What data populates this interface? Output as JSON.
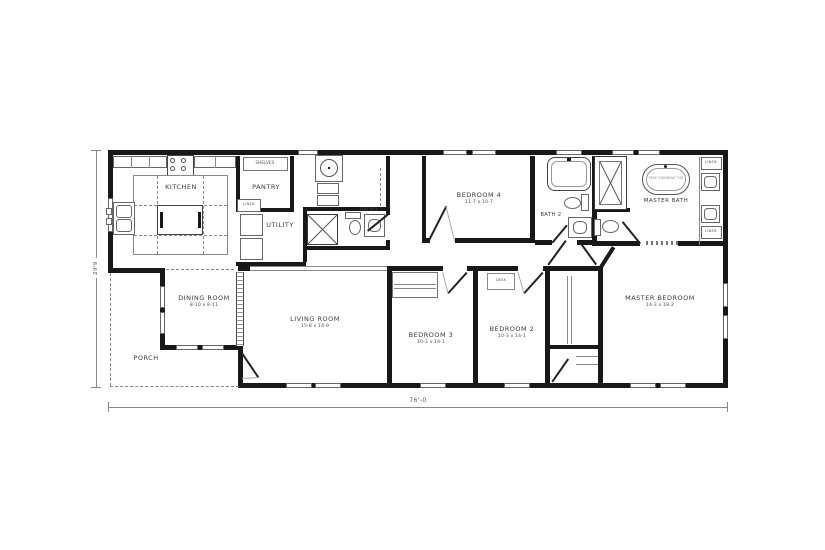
{
  "rooms": {
    "kitchen": {
      "label": "KITCHEN"
    },
    "pantry": {
      "label": "PANTRY"
    },
    "utility": {
      "label": "UTILITY"
    },
    "bath3": {
      "label": "BATH 3"
    },
    "bedroom4": {
      "label": "BEDROOM 4",
      "dims": "11-7 x 10-7"
    },
    "bath2": {
      "label": "BATH 2"
    },
    "master_bath": {
      "label": "MASTER BATH"
    },
    "dining_room": {
      "label": "DINING ROOM",
      "dims": "8-10 x 8-11"
    },
    "living_room": {
      "label": "LIVING ROOM",
      "dims": "15-8 x 14-9"
    },
    "bedroom3": {
      "label": "BEDROOM 3",
      "dims": "10-3 x 14-1"
    },
    "bedroom2": {
      "label": "BEDROOM 2",
      "dims": "10-3 x 14-1"
    },
    "master_bedroom": {
      "label": "MASTER BEDROOM",
      "dims": "14-3 x 18-2"
    },
    "porch": {
      "label": "PORCH"
    }
  },
  "callouts": {
    "shelves": "SHELVES",
    "pantry_linen": "LINEN",
    "linen_upper": "LINEN",
    "linen_lower": "LINEN",
    "desk": "DESK",
    "tub": "FREE STANDING TUB"
  },
  "dimensions": {
    "overall_width": "76'-0",
    "overall_depth": "29'9"
  },
  "colors": {
    "wall": "#181818",
    "line": "#777777",
    "label": "#3a3a3a",
    "background": "#ffffff"
  }
}
